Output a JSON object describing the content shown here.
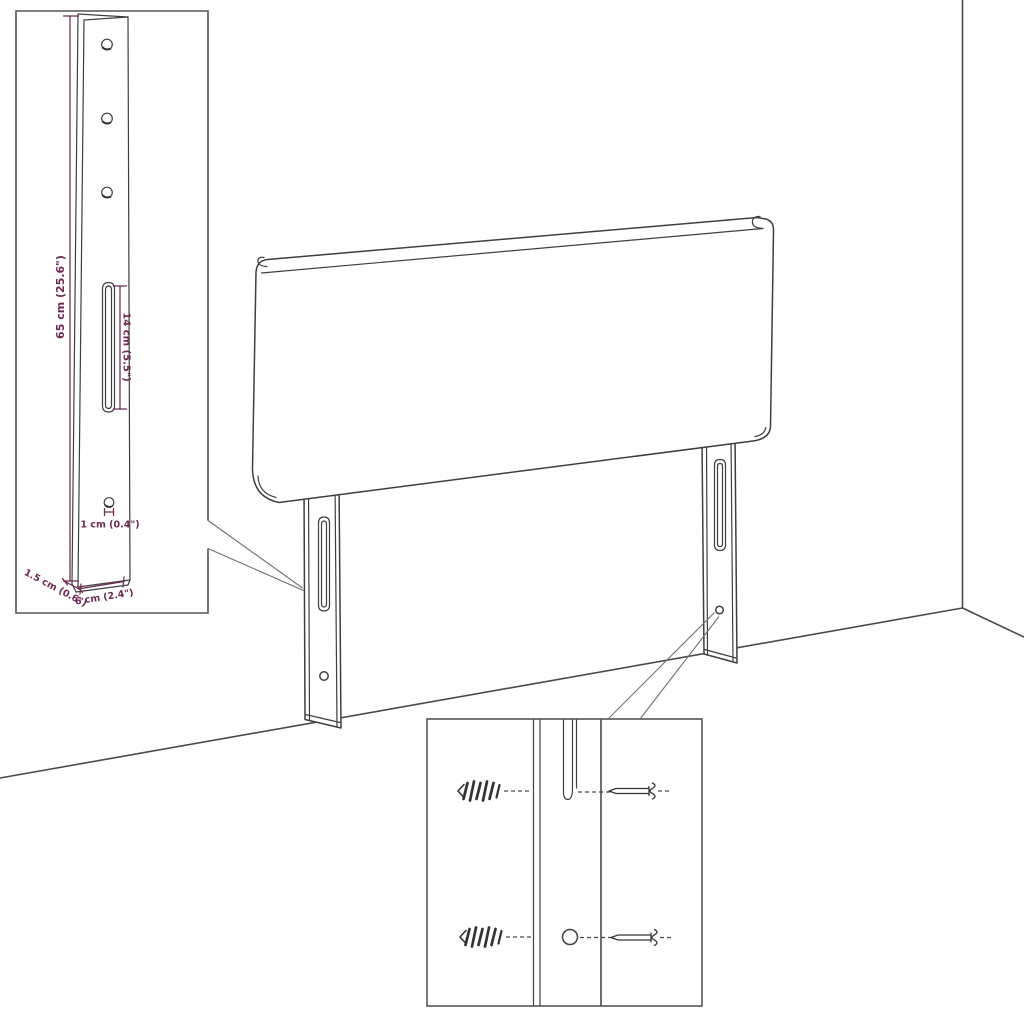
{
  "diagram": {
    "type": "product-dimension-diagram",
    "colors": {
      "line": "#3f3f3f",
      "dimension": "#6e2953",
      "background": "#ffffff"
    },
    "labels": {
      "bracket_height": "65 cm (25.6\")",
      "slot_length": "14 cm (5.5\")",
      "hole_diameter": "1 cm (0.4\")",
      "bracket_depth": "1.5 cm (0.6\")",
      "bracket_width": "6 cm (2.4\")"
    }
  }
}
